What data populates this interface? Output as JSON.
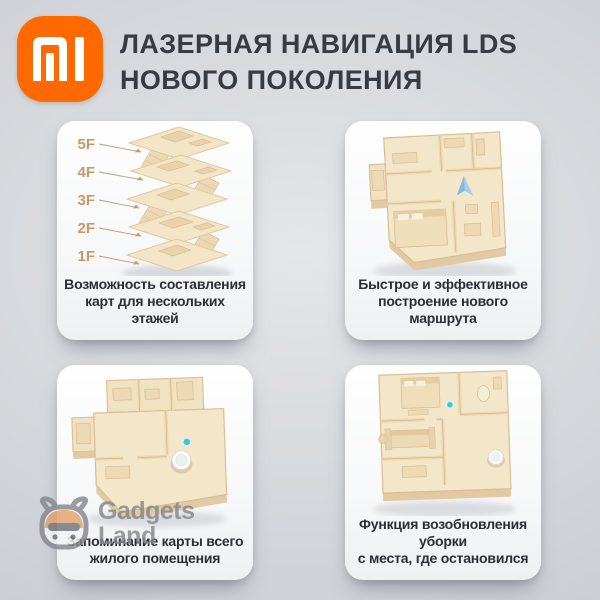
{
  "header": {
    "brand": "Xiaomi Mi",
    "title_line1": "ЛАЗЕРНАЯ НАВИГАЦИЯ LDS",
    "title_line2": "НОВОГО ПОКОЛЕНИЯ"
  },
  "cards": [
    {
      "illustration": "multi-floor-map",
      "floor_labels": [
        "5F",
        "4F",
        "3F",
        "2F",
        "1F"
      ],
      "caption_line1": "Возможность составления",
      "caption_line2": "карт для нескольких этажей"
    },
    {
      "illustration": "new-route-floorplan",
      "caption_line1": "Быстрое и эффективное",
      "caption_line2": "построение нового маршрута"
    },
    {
      "illustration": "whole-home-map-floorplan",
      "caption_line1": "Запоминание карты всего",
      "caption_line2": "жилого помещения"
    },
    {
      "illustration": "resume-cleaning-floorplan",
      "caption_line1": "Функция возобновления уборки",
      "caption_line2": "с места, где остановился"
    }
  ],
  "watermark": {
    "line1": "Gadgets",
    "line2": "Land",
    "icon": "gadgets-land-robot"
  },
  "colors": {
    "brand_orange": "#ff6900",
    "background_gray": "#c9ccd1",
    "card_white": "#fbfcfd",
    "illustration_beige": "#f4e6c8",
    "floor_label_tan": "#c59a6b",
    "arrow_blue": "#84b7e6",
    "dot_teal": "#3fc9cf",
    "title_text": "#383c42"
  }
}
